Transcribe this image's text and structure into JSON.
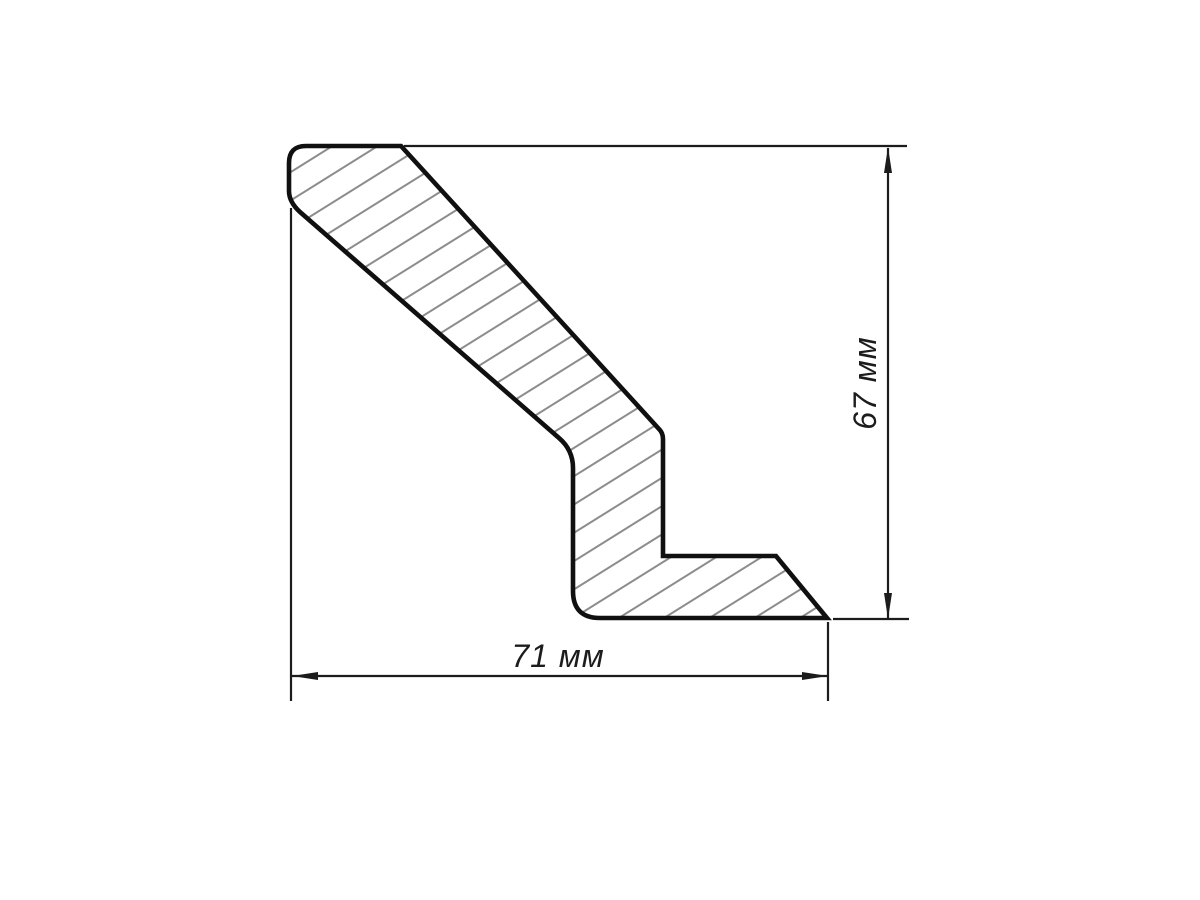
{
  "drawing": {
    "type": "technical-cross-section",
    "unit": "мм",
    "dimensions": {
      "height": {
        "value": 67,
        "label": "67 мм"
      },
      "width": {
        "value": 71,
        "label": "71 мм"
      }
    },
    "colors": {
      "background": "#ffffff",
      "outline": "#101010",
      "hatch": "#8c8c8c",
      "dimension_lines": "#1c1c1c",
      "arrow_fill": "#1c1c1c"
    },
    "hatch": {
      "direction": "up-right",
      "angle_deg": 32,
      "perpendicular_spacing_px": 24,
      "line_width_px": 2
    }
  }
}
